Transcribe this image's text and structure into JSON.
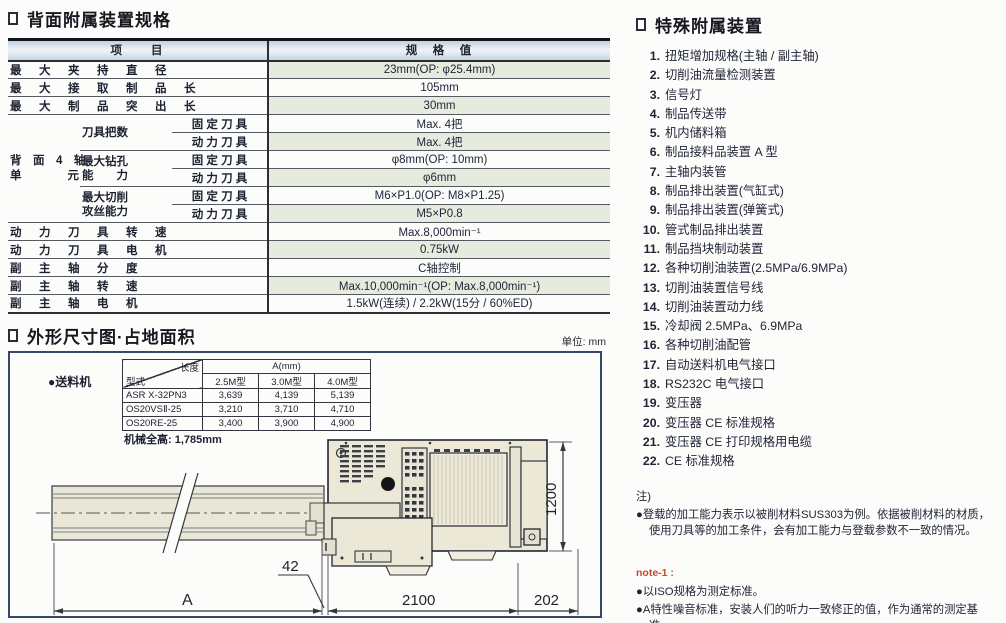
{
  "spec": {
    "title": "背面附属装置规格",
    "header": {
      "item": "项　　目",
      "value": "规　格　值"
    },
    "rows_top": [
      {
        "label": "最　大　夹　持　直　径",
        "value": "23mm(OP: φ25.4mm)"
      },
      {
        "label": "最　大　接　取　制　品　长",
        "value": "105mm"
      },
      {
        "label": "最　大　制　品　突　出　长",
        "value": "30mm"
      }
    ],
    "group": {
      "line1": "背　面　4　轴",
      "line2": "单　　　　元",
      "sub": [
        {
          "name1": "刀具把数",
          "name2": "",
          "fixed_label": "固 定 刀 具",
          "fixed_value": "Max. 4把",
          "power_label": "动 力 刀 具",
          "power_value": "Max. 4把"
        },
        {
          "name1": "最大钻孔",
          "name2": "能　　力",
          "fixed_label": "固 定 刀 具",
          "fixed_value": "φ8mm(OP: 10mm)",
          "power_label": "动 力 刀 具",
          "power_value": "φ6mm"
        },
        {
          "name1": "最大切削",
          "name2": "攻丝能力",
          "fixed_label": "固 定 刀 具",
          "fixed_value": "M6×P1.0(OP: M8×P1.25)",
          "power_label": "动 力 刀 具",
          "power_value": "M5×P0.8"
        }
      ]
    },
    "rows_bottom": [
      {
        "label": "动　力　刀　具　转　速",
        "value": "Max.8,000min⁻¹"
      },
      {
        "label": "动　力　刀　具　电　机",
        "value": "0.75kW"
      },
      {
        "label": "副　主　轴　分　度",
        "value": "C轴控制"
      },
      {
        "label": "副　主　轴　转　速",
        "value": "Max.10,000min⁻¹(OP: Max.8,000min⁻¹)"
      },
      {
        "label": "副　主　轴　电　机",
        "value": "1.5kW(连续) / 2.2kW(15分 / 60%ED)"
      }
    ]
  },
  "dim": {
    "title": "外形尺寸图·占地面积",
    "unit": "单位: mm",
    "feeder_label": "●送料机",
    "table": {
      "diag_top": "长度",
      "diag_bottom": "型式",
      "span": "A(mm)",
      "cols": [
        "2.5M型",
        "3.0M型",
        "4.0M型"
      ],
      "rows": [
        {
          "model": "ASR X-32PN3",
          "v": [
            "3,639",
            "4,139",
            "5,139"
          ]
        },
        {
          "model": "OS20VSⅡ-25",
          "v": [
            "3,210",
            "3,710",
            "4,710"
          ]
        },
        {
          "model": "OS20RE-25",
          "v": [
            "3,400",
            "3,900",
            "4,900"
          ]
        }
      ]
    },
    "height_note": "机械全高: 1,785mm",
    "d": {
      "a": "A",
      "gap": "42",
      "len": "2100",
      "right": "202",
      "depth": "1200"
    }
  },
  "special": {
    "title": "特殊附属装置",
    "items": [
      {
        "num": "1.",
        "text": "扭矩增加规格(主轴 / 副主轴)"
      },
      {
        "num": "2.",
        "text": "切削油流量检测装置"
      },
      {
        "num": "3.",
        "text": "信号灯"
      },
      {
        "num": "4.",
        "text": "制品传送带"
      },
      {
        "num": "5.",
        "text": "机内储料箱"
      },
      {
        "num": "6.",
        "text": "制品接料品装置 A 型"
      },
      {
        "num": "7.",
        "text": "主轴内装管"
      },
      {
        "num": "8.",
        "text": "制品排出装置(气缸式)"
      },
      {
        "num": "9.",
        "text": "制品排出装置(弹簧式)"
      },
      {
        "num": "10.",
        "text": "管式制品排出装置"
      },
      {
        "num": "11.",
        "text": "制品挡块制动装置"
      },
      {
        "num": "12.",
        "text": "各种切削油装置(2.5MPa/6.9MPa)"
      },
      {
        "num": "13.",
        "text": "切削油装置信号线"
      },
      {
        "num": "14.",
        "text": "切削油装置动力线"
      },
      {
        "num": "15.",
        "text": "冷却阀 2.5MPa、6.9MPa"
      },
      {
        "num": "16.",
        "text": "各种切削油配管"
      },
      {
        "num": "17.",
        "text": "自动送料机电气接口"
      },
      {
        "num": "18.",
        "text": "RS232C 电气接口"
      },
      {
        "num": "19.",
        "text": "变压器"
      },
      {
        "num": "20.",
        "text": "变压器 CE 标准规格"
      },
      {
        "num": "21.",
        "text": "变压器 CE 打印规格用电缆"
      },
      {
        "num": "22.",
        "text": "CE 标准规格"
      }
    ]
  },
  "notes": {
    "head": "注)",
    "para": "●登载的加工能力表示以被削材料SUS303为例。依据被削材料的材质，使用刀具等的加工条件，会有加工能力与登载参数不一致的情况。",
    "note1_label": "note-1 :",
    "b1": "●以ISO规格为测定标准。",
    "b2": "●A特性噪音标准，安装人们的听力一致修正的值，作为通常的测定基准。",
    "accent_color": "#c64a26"
  }
}
